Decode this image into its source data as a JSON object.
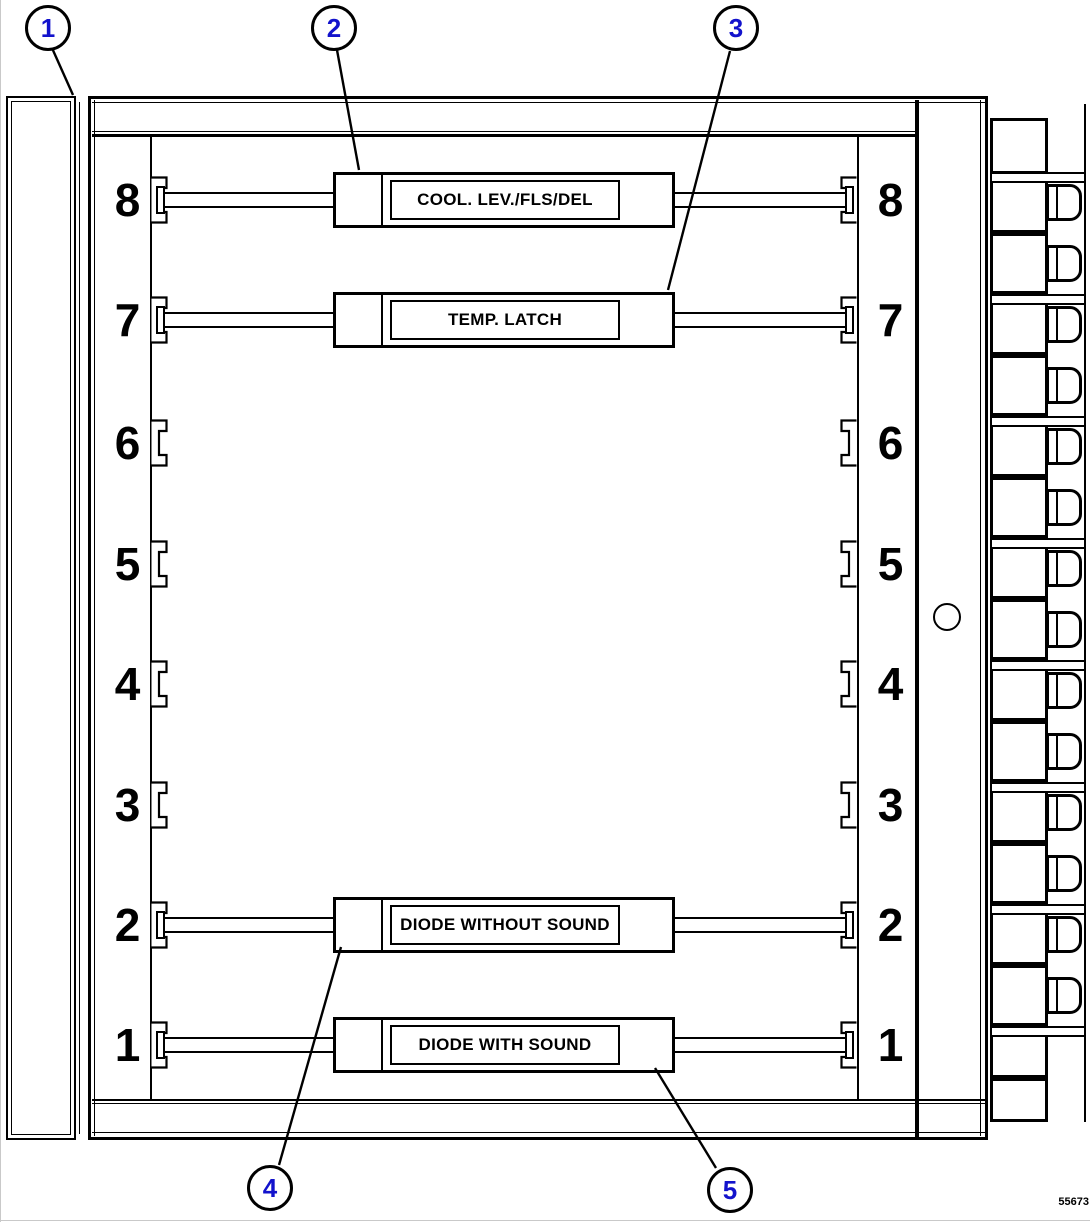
{
  "figure": {
    "number": "55673"
  },
  "callouts": [
    {
      "label": "1"
    },
    {
      "label": "2"
    },
    {
      "label": "3"
    },
    {
      "label": "4"
    },
    {
      "label": "5"
    }
  ],
  "slots": [
    {
      "num": "8",
      "module": "COOL. LEV./FLS/DEL"
    },
    {
      "num": "7",
      "module": "TEMP. LATCH"
    },
    {
      "num": "6",
      "module": null
    },
    {
      "num": "5",
      "module": null
    },
    {
      "num": "4",
      "module": null
    },
    {
      "num": "3",
      "module": null
    },
    {
      "num": "2",
      "module": "DIODE WITHOUT SOUND"
    },
    {
      "num": "1",
      "module": "DIODE WITH SOUND"
    }
  ],
  "connectors": {
    "count": 14
  },
  "colors": {
    "line": "#000000",
    "callout": "#1212cc",
    "background": "#ffffff"
  }
}
